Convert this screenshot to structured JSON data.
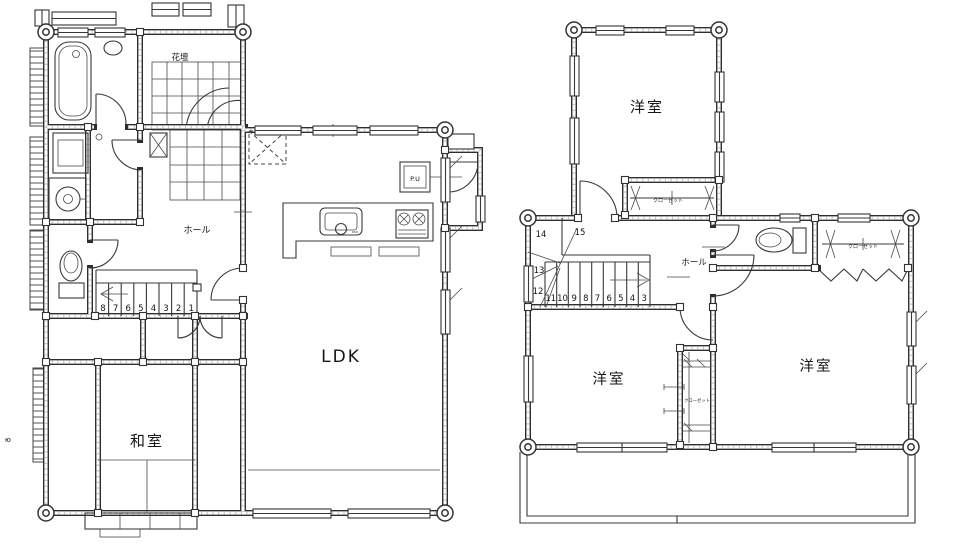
{
  "colors": {
    "ink": "#2e2e2e",
    "background": "#ffffff",
    "texture": "#c8c8c8"
  },
  "floor1": {
    "labels": {
      "flower_bed": "花壇",
      "hall": "ホール",
      "ldk": "LDK",
      "japanese_room": "和室",
      "pipe_unit": "P.U"
    },
    "stair_numbers": [
      "8",
      "7",
      "6",
      "5",
      "4",
      "3",
      "2",
      "1"
    ]
  },
  "floor2": {
    "labels": {
      "bedroom_top": "洋室",
      "bedroom_left": "洋室",
      "bedroom_right": "洋室",
      "hall": "ホール",
      "closet_top": "クローゼット",
      "closet_right": "クローゼット",
      "closet_middle": "クローゼット"
    },
    "stair_lower_numbers": [
      "11",
      "10",
      "9",
      "8",
      "7",
      "6",
      "5",
      "4",
      "3"
    ],
    "stair_upper_numbers": [
      "14",
      "15",
      "13",
      "12"
    ]
  },
  "stray_mark": "ю"
}
